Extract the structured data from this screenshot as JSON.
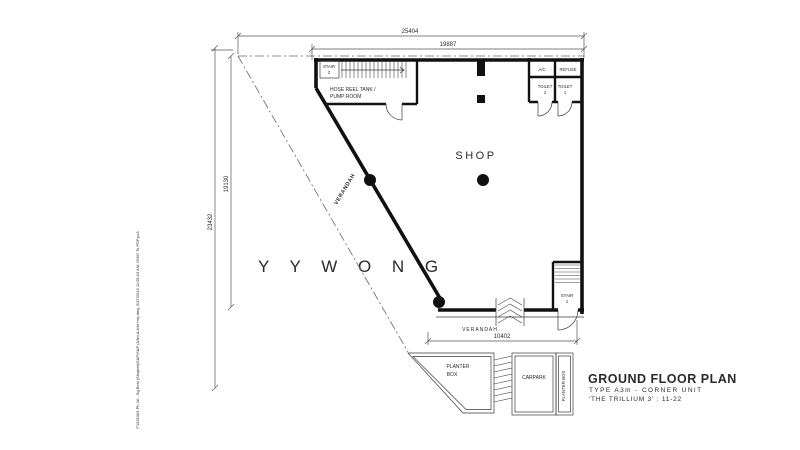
{
  "page": {
    "background": "#ffffff",
    "ink_color": "#1a1a1a",
    "watermark_color": "#d2d2d2"
  },
  "labels": {
    "shop": "SHOP",
    "verandah_side": "VERANDAH",
    "verandah_bottom": "VERANDAH",
    "stair2_line1": "STAIR",
    "stair2_line2": "2",
    "stair1_line1": "STAIR",
    "stair1_line2": "1",
    "pump_room_line1": "HOSE REEL TANK /",
    "pump_room_line2": "PUMP ROOM",
    "ac_ledge": "A/C",
    "refuse": "REFUSE",
    "toilet2_line1": "TOILET",
    "toilet2_line2": "2",
    "toilet1_line1": "TOILET",
    "toilet1_line2": "1",
    "planter_left_line1": "PLANTER",
    "planter_left_line2": "BOX",
    "carpark": "CARPARK",
    "planter_right": "PLANTER BOX"
  },
  "dimensions": {
    "top_outer": "25404",
    "top_inner": "19887",
    "left_outer": "23432",
    "left_inner": "19130",
    "bottom": "10402"
  },
  "titleblock": {
    "title": "GROUND FLOOR PLAN",
    "type_line": "TYPE A3m - CORNER UNIT",
    "project_line": "'THE TRILLIUM 3' : 11-22"
  },
  "watermark": "Y Y   W O N G",
  "plot_stamp": "F1031003 Ph 2A - Sg Besi (Shoplot)\\S&P\\S&P (A3m & A3s+m).dwg, 5/17/2013 11:05:13 AM, DWG To PDF.pc3"
}
